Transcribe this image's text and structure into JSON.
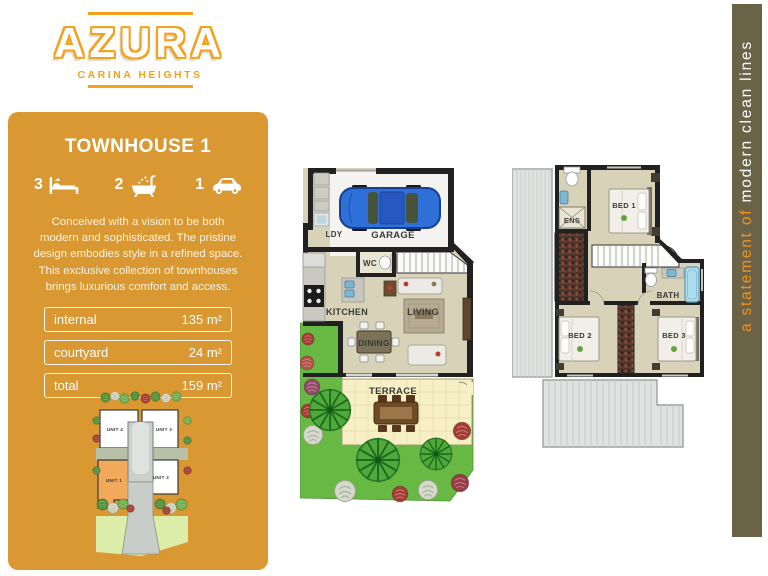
{
  "logo": {
    "title": "AZURA",
    "subtitle": "CARINA HEIGHTS"
  },
  "sidebar": {
    "title": "TOWNHOUSE 1",
    "features": {
      "beds": "3",
      "baths": "2",
      "cars": "1"
    },
    "description": "Conceived with a vision to be both modern and sophisticated. The pristine design embodies style in a refined space. This exclusive collection of townhouses brings luxurious comfort and access.",
    "areas": [
      {
        "label": "internal",
        "value": "135 m²"
      },
      {
        "label": "courtyard",
        "value": "24 m²"
      },
      {
        "label": "total",
        "value": "159 m²"
      }
    ]
  },
  "site_plan": {
    "unit4": "UNIT 4",
    "unit3": "UNIT 3",
    "unit1": "UNIT 1",
    "unit2": "UNIT 2",
    "highlighted_unit": "UNIT 1"
  },
  "ground_floor": {
    "ldy": "LDY",
    "garage": "GARAGE",
    "wc": "WC",
    "kitchen": "KITCHEN",
    "living": "LIVING",
    "dining": "DINING",
    "terrace": "TERRACE"
  },
  "upper_floor": {
    "ens": "ENS",
    "bed1": "BED 1",
    "bath": "BATH",
    "bed2": "BED 2",
    "bed3": "BED 3"
  },
  "tagline": {
    "lead": "a statement of ",
    "emphasis": "modern clean lines"
  },
  "colors": {
    "accent_orange": "#d99832",
    "logo_orange": "#f4a11e",
    "tagline_bar": "#6b6347",
    "unit_highlight": "#f2a95c",
    "grass_green": "#67b944"
  }
}
